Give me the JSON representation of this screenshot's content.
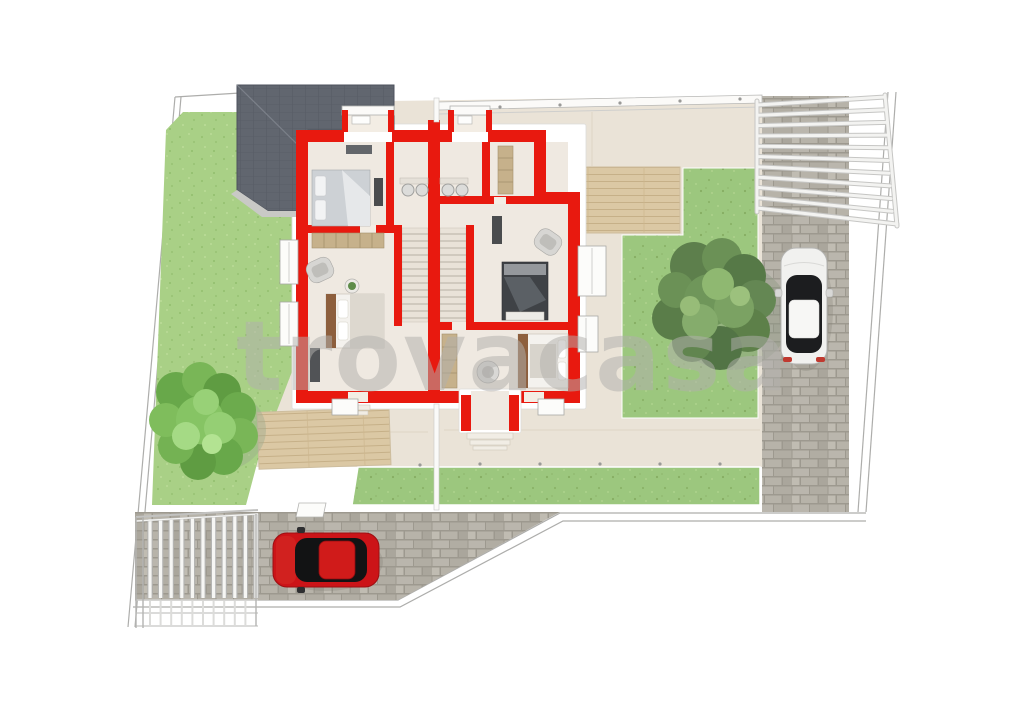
{
  "scene": {
    "type": "real-estate-floorplan-render",
    "description": "Top-down 3D rendering of a semi-detached two-unit house floor plan with red walls, surrounded by lawns, wooden decks, paved driveways, a pergola, a carport fence, two trees and two parked cars",
    "watermark": {
      "text": "trovacasa"
    }
  },
  "palette": {
    "background": "#ffffff",
    "wall_red": "#e8190f",
    "floor_beige": "#efe9e1",
    "apron_beige": "#eae3d7",
    "grass_left": "#a9d086",
    "grass_right": "#9cc77e",
    "deck_wood": "#dbc8a4",
    "deck_line": "#c6b088",
    "paving_gray": "#b7b3aa",
    "paving_joint": "#9d998f",
    "roof_slate": "#61666f",
    "tree_green_dark": "#5d7f4c",
    "tree_green_light": "#8fb871",
    "tree_green_bright": "#7fbb55",
    "car_red": "#cc1418",
    "car_white": "#f1f1ef",
    "glass_black": "#1c1d1f",
    "wood_brown": "#8d5f3d",
    "shelf_tan": "#c6b18b",
    "watermark_gray": "#b2b0ad",
    "outline_gray": "#b0b0ae"
  },
  "objects": [
    {
      "name": "hip-roof",
      "description": "dark slate hip roof over left unit rear"
    },
    {
      "name": "floorplan-red-walls",
      "description": "bright red wall layout of two mirrored units"
    },
    {
      "name": "staircase-left",
      "description": "staircase of left unit"
    },
    {
      "name": "staircase-right",
      "description": "staircase of right unit"
    },
    {
      "name": "beds",
      "description": "four double beds with pillows and blankets"
    },
    {
      "name": "wardrobes",
      "description": "tan open shelving wardrobes"
    },
    {
      "name": "bathroom-sinks",
      "description": "twin wash basins in each unit"
    },
    {
      "name": "tree-right",
      "description": "large dark green tree in right garden"
    },
    {
      "name": "tree-left",
      "description": "bright green tree on left lawn"
    },
    {
      "name": "car-white",
      "description": "white car parked on right driveway"
    },
    {
      "name": "car-red",
      "description": "red car parked on bottom driveway"
    },
    {
      "name": "pergola",
      "description": "white slatted pergola over top-right driveway"
    },
    {
      "name": "carport-fence",
      "description": "white barred gate structure bottom-left"
    },
    {
      "name": "wood-decks",
      "description": "timber decks beside the house"
    },
    {
      "name": "lawns",
      "description": "green garden lawns"
    },
    {
      "name": "driveways",
      "description": "gray block-paved driveways"
    }
  ]
}
